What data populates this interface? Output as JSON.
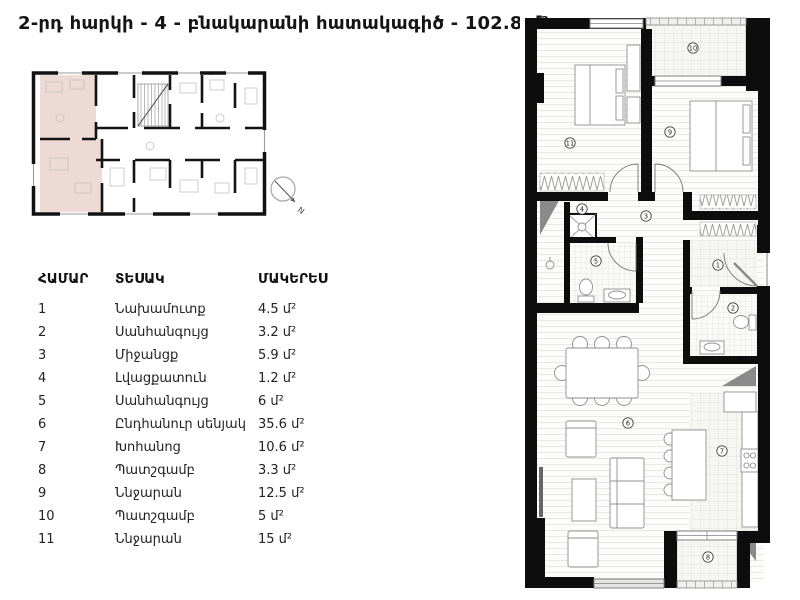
{
  "page": {
    "title": "2-րդ հարկի - 4 - բնակարանի հատակագիծ - 102.8 մ²"
  },
  "table": {
    "headers": [
      "ՀԱՄԱՐ",
      "ՏԵՍԱԿ",
      "ՄԱԿԵՐԵՍ"
    ],
    "rows": [
      {
        "num": "1",
        "type": "Նախամուտք",
        "area": "4.5 մ²"
      },
      {
        "num": "2",
        "type": "Սանհանգույց",
        "area": "3.2 մ²"
      },
      {
        "num": "3",
        "type": "Միջանցք",
        "area": "5.9 մ²"
      },
      {
        "num": "4",
        "type": "Լվացքատուն",
        "area": "1.2 մ²"
      },
      {
        "num": "5",
        "type": "Սանհանգույց",
        "area": "6 մ²"
      },
      {
        "num": "6",
        "type": "Ընդհանուր սենյակ",
        "area": "35.6 մ²"
      },
      {
        "num": "7",
        "type": "Խոհանոց",
        "area": "10.6 մ²"
      },
      {
        "num": "8",
        "type": "Պատշգամբ",
        "area": "3.3 մ²"
      },
      {
        "num": "9",
        "type": "Ննջարան",
        "area": "12.5 մ²"
      },
      {
        "num": "10",
        "type": "Պատշգամբ",
        "area": "5 մ²"
      },
      {
        "num": "11",
        "type": "Ննջարան",
        "area": "15 մ²"
      }
    ]
  },
  "plan": {
    "compass_label": "N",
    "room_markers": [
      {
        "num": "1",
        "x": 198,
        "y": 250
      },
      {
        "num": "2",
        "x": 213,
        "y": 293
      },
      {
        "num": "3",
        "x": 126,
        "y": 201
      },
      {
        "num": "4",
        "x": 62,
        "y": 194
      },
      {
        "num": "5",
        "x": 76,
        "y": 246
      },
      {
        "num": "6",
        "x": 108,
        "y": 408
      },
      {
        "num": "7",
        "x": 202,
        "y": 436
      },
      {
        "num": "8",
        "x": 188,
        "y": 542
      },
      {
        "num": "9",
        "x": 150,
        "y": 117
      },
      {
        "num": "10",
        "x": 173,
        "y": 33
      },
      {
        "num": "11",
        "x": 50,
        "y": 128
      }
    ]
  },
  "colors": {
    "highlight_apartment": "#eddad5",
    "walls": "#0d0d0d"
  }
}
